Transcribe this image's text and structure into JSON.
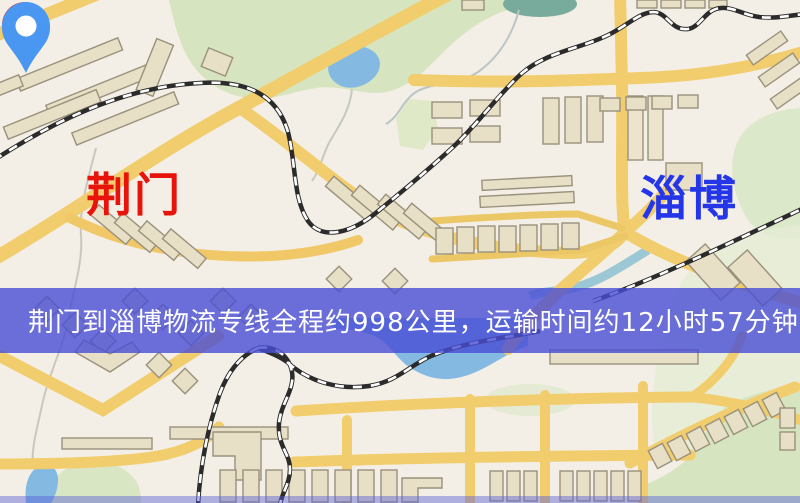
{
  "map": {
    "origin_marker": {
      "label": "荆门",
      "pin_color": "#f2170e",
      "label_color": "#e8130b"
    },
    "destination_marker": {
      "label": "淄博",
      "pin_color": "#4a97f2",
      "label_color": "#2436e8"
    },
    "info_banner": {
      "text": "荆门到淄博物流专线全程约998公里，运输时间约12小时57分钟.",
      "background": "rgba(72,78,213,0.80)",
      "text_color": "#ffffff"
    },
    "map_colors": {
      "base": "#f4efe6",
      "road": "#f2cd6d",
      "park": "#d6e5c0",
      "water": "#84b9e2",
      "railway": "#2b2b2b",
      "building": "#e7dfc6"
    }
  }
}
